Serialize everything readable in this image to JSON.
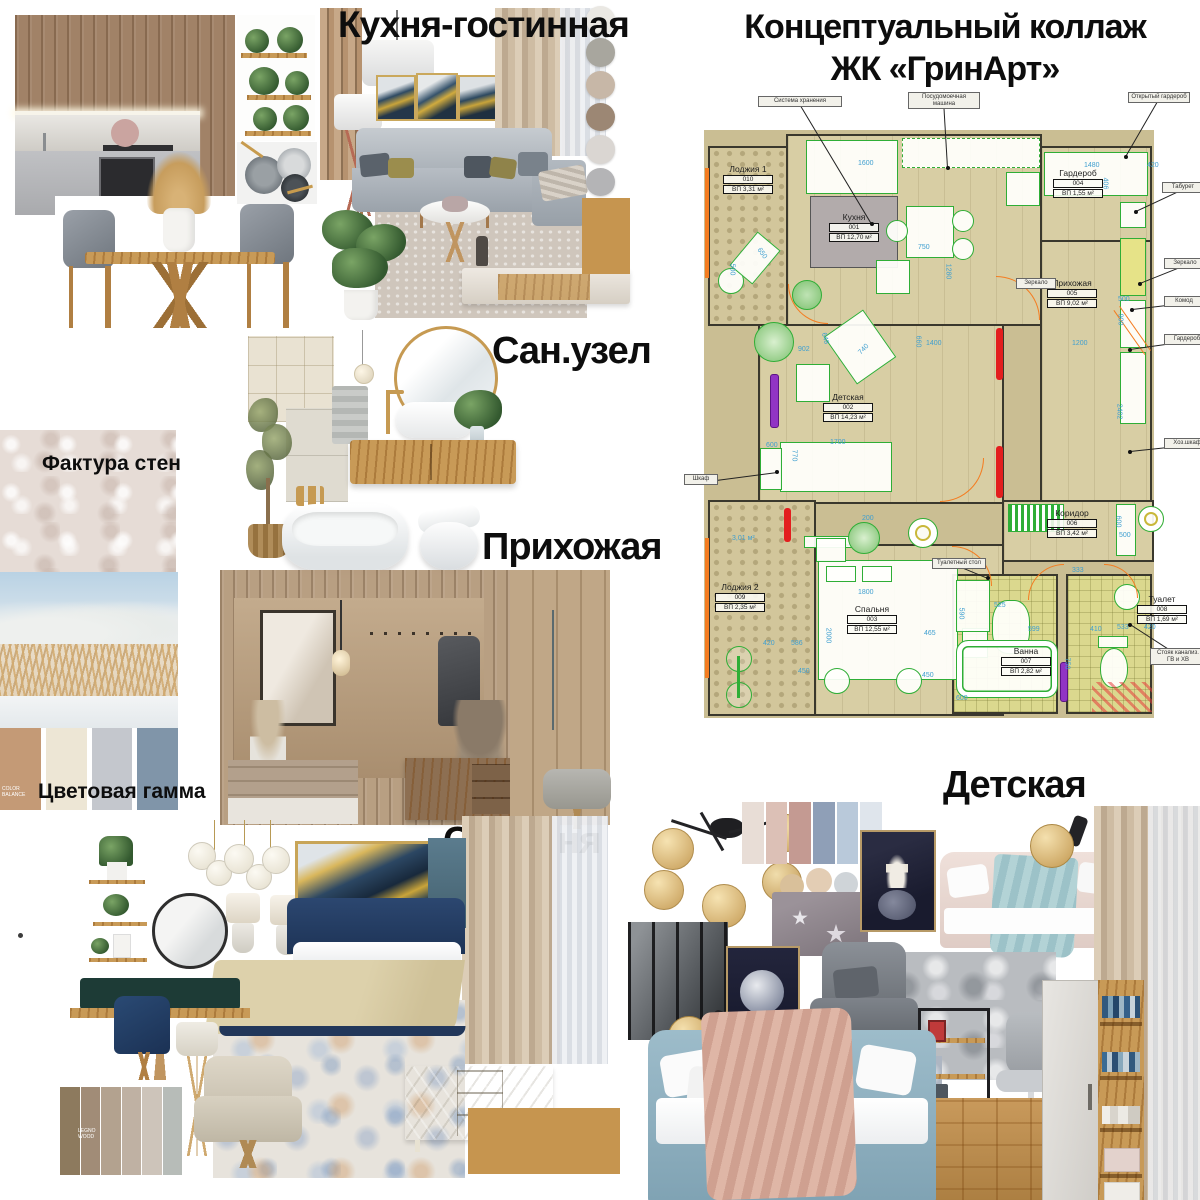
{
  "title": {
    "line1": "Концептуальный коллаж",
    "line2": "ЖК «ГринАрт»"
  },
  "sections": {
    "kitchen_living": "Кухня-гостинная",
    "bathroom": "Сан.узел",
    "hallway": "Прихожая",
    "bedroom": "Спальня",
    "kids": "Детская",
    "wall_texture": "Фактура стен",
    "color_scheme": "Цветовая гамма"
  },
  "swatch_notes": {
    "balance": "COLOR BALANCE",
    "wood": "LEGNO WOOD"
  },
  "plan": {
    "rooms": [
      {
        "name": "Лоджия 1",
        "id": "010",
        "area": "ВП 3,31 м²",
        "x": 18,
        "y": 56
      },
      {
        "name": "Кухня",
        "id": "001",
        "area": "ВП 12,70 м²",
        "x": 124,
        "y": 104
      },
      {
        "name": "Гардероб",
        "id": "004",
        "area": "ВП 1,55 м²",
        "x": 348,
        "y": 60
      },
      {
        "name": "Прихожая",
        "id": "005",
        "area": "ВП 9,02 м²",
        "x": 342,
        "y": 170
      },
      {
        "name": "Детская",
        "id": "002",
        "area": "ВП 14,23 м²",
        "x": 118,
        "y": 284
      },
      {
        "name": "Коридор",
        "id": "006",
        "area": "ВП 3,42 м²",
        "x": 342,
        "y": 400
      },
      {
        "name": "Лоджия 2",
        "id": "009",
        "area": "ВП 2,35 м²",
        "x": 10,
        "y": 474
      },
      {
        "name": "Спальня",
        "id": "003",
        "area": "ВП 12,55 м²",
        "x": 142,
        "y": 496
      },
      {
        "name": "Ванна",
        "id": "007",
        "area": "ВП 2,82 м²",
        "x": 296,
        "y": 538
      },
      {
        "name": "Туалет",
        "id": "008",
        "area": "ВП 1,69 м²",
        "x": 432,
        "y": 486
      }
    ],
    "callouts": [
      {
        "label": "Система хранения",
        "x": 58,
        "y": -12,
        "w": 84,
        "tx": 172,
        "ty": 116
      },
      {
        "label": "Посудомоечная машина",
        "x": 208,
        "y": -16,
        "w": 72,
        "tx": 248,
        "ty": 60
      },
      {
        "label": "Открытый гардероб",
        "x": 428,
        "y": -16,
        "w": 62,
        "tx": 426,
        "ty": 49
      },
      {
        "label": "Табурет",
        "x": 462,
        "y": 74,
        "w": 42,
        "tx": 436,
        "ty": 104
      },
      {
        "label": "Зеркало",
        "x": 464,
        "y": 150,
        "w": 42,
        "tx": 440,
        "ty": 176
      },
      {
        "label": "Комод",
        "x": 464,
        "y": 188,
        "w": 40,
        "tx": 432,
        "ty": 202
      },
      {
        "label": "Гардероб",
        "x": 464,
        "y": 226,
        "w": 46,
        "tx": 430,
        "ty": 242
      },
      {
        "label": "Хоз.шкаф",
        "x": 464,
        "y": 330,
        "w": 46,
        "tx": 430,
        "ty": 344
      },
      {
        "label": "Стояк канализ. ГВ и ХВ",
        "x": 450,
        "y": 540,
        "w": 56,
        "tx": 430,
        "ty": 517
      },
      {
        "label": "Шкаф",
        "x": -16,
        "y": 366,
        "w": 34,
        "tx": 77,
        "ty": 364
      },
      {
        "label": "Зеркало",
        "x": 316,
        "y": 170,
        "w": 40
      },
      {
        "label": "Туалетный стол",
        "x": 232,
        "y": 450,
        "w": 54,
        "tx": 288,
        "ty": 470
      }
    ],
    "dimensions": [
      {
        "t": "1600",
        "x": 158,
        "y": 52
      },
      {
        "t": "1480",
        "x": 384,
        "y": 54
      },
      {
        "t": "420",
        "x": 447,
        "y": 54
      },
      {
        "t": "406",
        "x": 399,
        "y": 72,
        "r": 90
      },
      {
        "t": "750",
        "x": 218,
        "y": 136
      },
      {
        "t": "1280",
        "x": 240,
        "y": 160,
        "r": 90
      },
      {
        "t": "500",
        "x": 26,
        "y": 158,
        "r": 90
      },
      {
        "t": "650",
        "x": 56,
        "y": 142,
        "r": 55
      },
      {
        "t": "500",
        "x": 418,
        "y": 188
      },
      {
        "t": "900",
        "x": 414,
        "y": 208,
        "r": 90
      },
      {
        "t": "1200",
        "x": 372,
        "y": 232
      },
      {
        "t": "2402",
        "x": 411,
        "y": 300,
        "r": 90
      },
      {
        "t": "902",
        "x": 98,
        "y": 238
      },
      {
        "t": "648",
        "x": 119,
        "y": 227,
        "r": 75
      },
      {
        "t": "740",
        "x": 158,
        "y": 238,
        "r": -45
      },
      {
        "t": "660",
        "x": 212,
        "y": 230,
        "r": 90
      },
      {
        "t": "1400",
        "x": 226,
        "y": 232
      },
      {
        "t": "600",
        "x": 66,
        "y": 334
      },
      {
        "t": "1700",
        "x": 130,
        "y": 331
      },
      {
        "t": "770",
        "x": 88,
        "y": 344,
        "r": 90
      },
      {
        "t": "600",
        "x": 412,
        "y": 410,
        "r": 90
      },
      {
        "t": "500",
        "x": 419,
        "y": 424
      },
      {
        "t": "200",
        "x": 162,
        "y": 407
      },
      {
        "t": "3,01 м²",
        "x": 32,
        "y": 427
      },
      {
        "t": "333",
        "x": 372,
        "y": 459
      },
      {
        "t": "1800",
        "x": 158,
        "y": 481
      },
      {
        "t": "2000",
        "x": 120,
        "y": 524,
        "r": 90
      },
      {
        "t": "420",
        "x": 63,
        "y": 532
      },
      {
        "t": "586",
        "x": 91,
        "y": 532
      },
      {
        "t": "450",
        "x": 98,
        "y": 560
      },
      {
        "t": "465",
        "x": 224,
        "y": 522
      },
      {
        "t": "450",
        "x": 222,
        "y": 564
      },
      {
        "t": "525",
        "x": 294,
        "y": 494
      },
      {
        "t": "590",
        "x": 255,
        "y": 502,
        "r": 90
      },
      {
        "t": "599",
        "x": 328,
        "y": 518
      },
      {
        "t": "410",
        "x": 390,
        "y": 518
      },
      {
        "t": "533",
        "x": 417,
        "y": 516
      },
      {
        "t": "420",
        "x": 444,
        "y": 516
      },
      {
        "t": "750",
        "x": 361,
        "y": 552,
        "r": 90
      },
      {
        "t": "600",
        "x": 256,
        "y": 587
      }
    ]
  },
  "palettes": {
    "living_circles": [
      "#eae8e3",
      "#a8a69e",
      "#c7b7a7",
      "#9c8774",
      "#dad6d2",
      "#b4b4b6"
    ],
    "wall": [
      "#c49a76",
      "#ede6d5",
      "#c4c7cd",
      "#8095a9"
    ],
    "bedroom_strips": [
      "#8d7a5e",
      "#a18c77",
      "#b3a28f",
      "#bfb1a3",
      "#cdc4ba",
      "#b7bcb8"
    ],
    "kids_swatches": [
      "#e8ddd6",
      "#dcc0b6",
      "#c49a92",
      "#8f9fb7",
      "#b9c9da",
      "#dfe5ec"
    ]
  }
}
